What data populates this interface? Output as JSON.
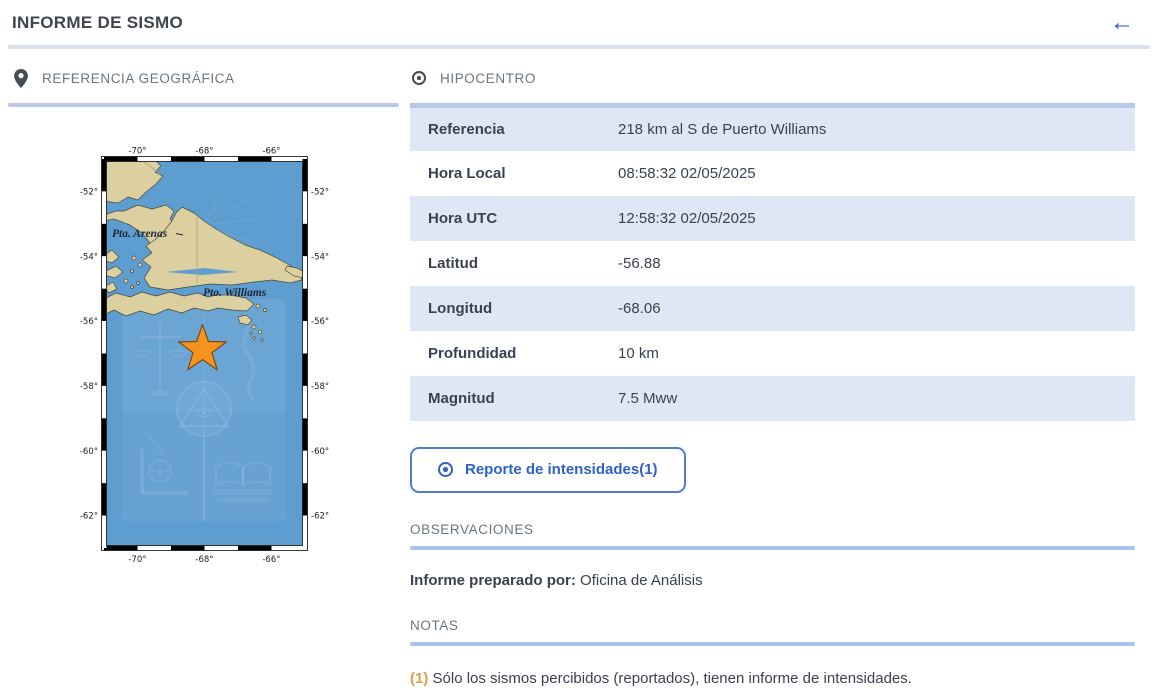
{
  "header": {
    "title": "INFORME DE SISMO",
    "back_icon": "←"
  },
  "geo": {
    "section_title": "REFERENCIA GEOGRÁFICA"
  },
  "hipocentro": {
    "section_title": "HIPOCENTRO",
    "rows": [
      {
        "label": "Referencia",
        "value": "218 km al S de Puerto Williams"
      },
      {
        "label": "Hora Local",
        "value": "08:58:32 02/05/2025"
      },
      {
        "label": "Hora UTC",
        "value": "12:58:32 02/05/2025"
      },
      {
        "label": "Latitud",
        "value": "-56.88"
      },
      {
        "label": "Longitud",
        "value": "-68.06"
      },
      {
        "label": "Profundidad",
        "value": "10 km"
      },
      {
        "label": "Magnitud",
        "value": "7.5 Mww"
      }
    ],
    "intensity_button_label": "Reporte de intensidades(1)"
  },
  "observaciones": {
    "section_title": "OBSERVACIONES",
    "prepared_by_label": "Informe preparado por:",
    "prepared_by_value": "Oficina de Análisis"
  },
  "notas": {
    "section_title": "NOTAS",
    "note_marker": "(1)",
    "note_text": "Sólo los sismos percibidos (reportados), tienen informe de intensidades."
  },
  "map": {
    "lon_ticks": [
      {
        "v": -70,
        "label": "-70°"
      },
      {
        "v": -68,
        "label": "-68°"
      },
      {
        "v": -66,
        "label": "-66°"
      }
    ],
    "lat_ticks": [
      {
        "v": -52,
        "label": "-52°"
      },
      {
        "v": -54,
        "label": "-54°"
      },
      {
        "v": -56,
        "label": "-56°"
      },
      {
        "v": -58,
        "label": "-58°"
      },
      {
        "v": -60,
        "label": "-60°"
      },
      {
        "v": -62,
        "label": "-62°"
      }
    ],
    "labels": [
      "Pta. Arenas",
      "Pto. Williams"
    ],
    "star": {
      "lat": -56.88,
      "lon": -68.06
    },
    "colors": {
      "ocean": "#5e9dcf",
      "land": "#dccfa0",
      "coast": "#4b4a38",
      "star_fill": "#f6921e",
      "star_stroke": "#7a4a10"
    }
  },
  "colors": {
    "accent_blue": "#2e62c6",
    "row_alt": "#dfe7f6",
    "divider": "#a6c3e8",
    "orange": "#dd9f47"
  }
}
